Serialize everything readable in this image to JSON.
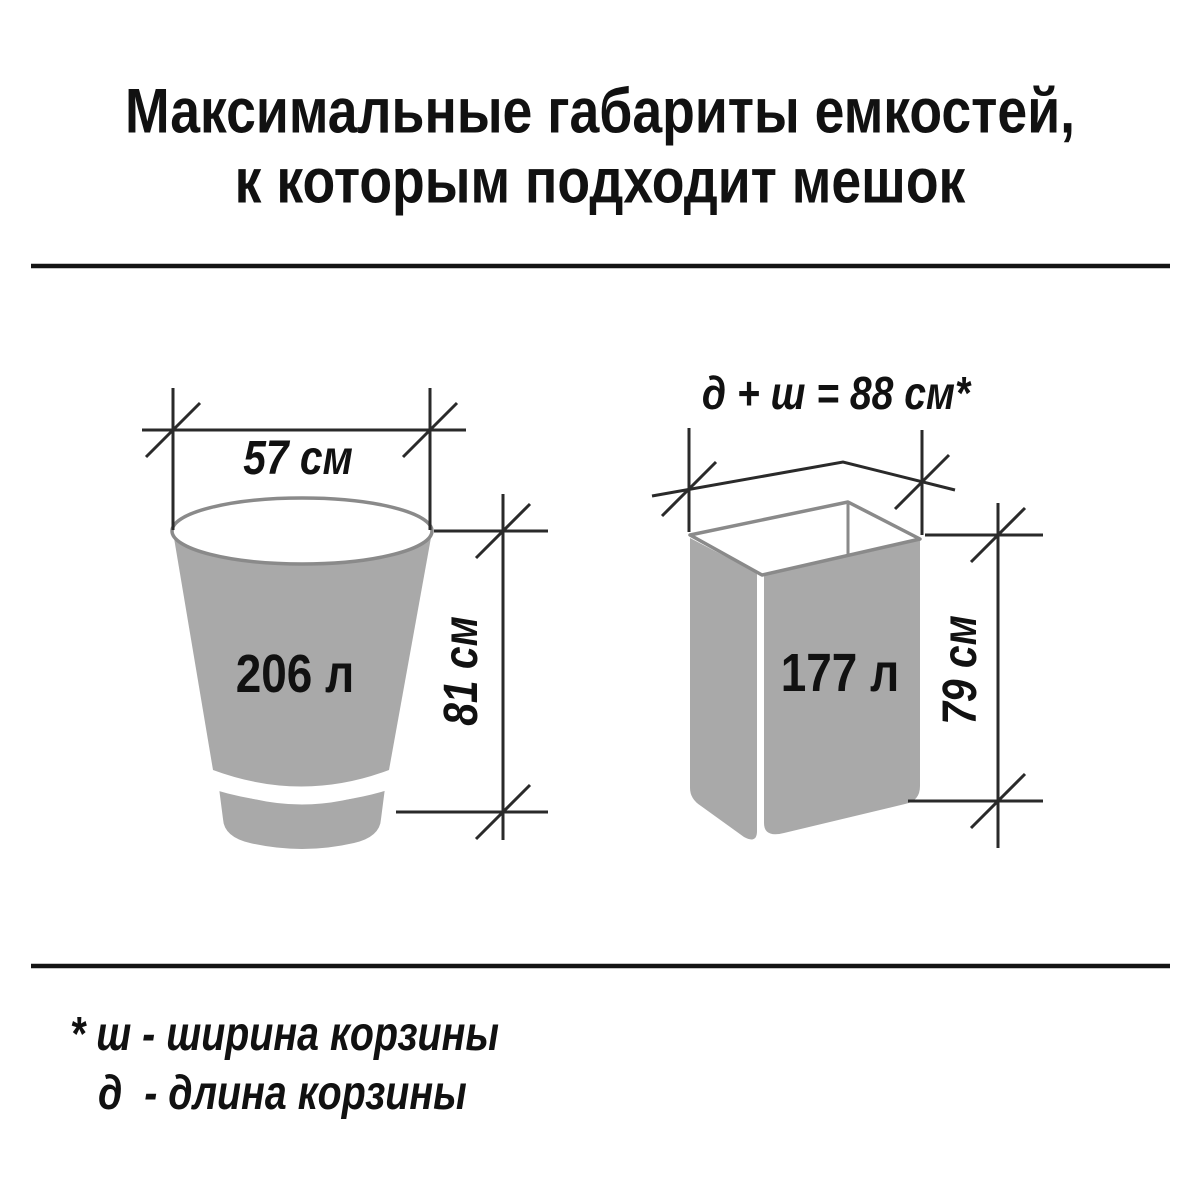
{
  "title": {
    "line1": "Максимальные габариты емкостей,",
    "line2": "к которым подходит мешок"
  },
  "bucket": {
    "width_label": "57 см",
    "height_label": "81 см",
    "volume_label": "206 л"
  },
  "basket": {
    "dimension_sum_label": "д + ш = 88 см*",
    "height_label": "79 см",
    "volume_label": "177 л"
  },
  "footnote": {
    "line1": "* ш - ширина корзины",
    "line2": "д  - длина корзины"
  },
  "colors": {
    "background": "#ffffff",
    "container_fill": "#a9a9a9",
    "outline": "#8a8a8a",
    "dimension_line": "#2a2a2a",
    "divider": "#141414",
    "text": "#111111"
  }
}
